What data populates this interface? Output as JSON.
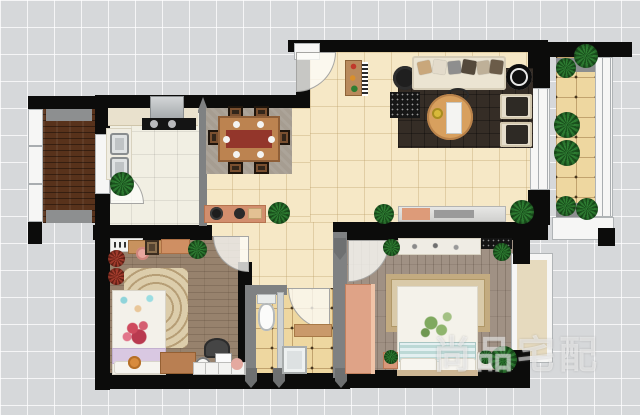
{
  "image": {
    "type": "apartment-floor-plan-rendering",
    "width_px": 640,
    "height_px": 415
  },
  "watermark": {
    "text": "尚品宅配"
  },
  "palette": {
    "background_grid": "#d6d8da",
    "wall_black": "#0c0c0b",
    "wall_grey": "#7f8182",
    "tile_living": "#f6e8c6",
    "tile_bathroom_balcony": "#eed7a0",
    "tile_kitchen": "#f1efe3",
    "wood_balcony_dark": "#58321b",
    "wood_bedroom": "#97826d",
    "wood_master": "#a09184",
    "rug_living_dark": "#352d26",
    "rug_dining_stone": "#a69d91",
    "rug_mandala": "#dccdab",
    "sofa_cream": "#ebe4d2",
    "table_wood": "#d8a05e",
    "accent_salmon": "#d28e6d",
    "plant_green": "#2e7d32"
  },
  "rooms": [
    {
      "name": "entry"
    },
    {
      "name": "living-room",
      "furniture": [
        "sofa",
        "coffee-table",
        "armchairs",
        "tv-cabinet",
        "side-table",
        "rug",
        "console"
      ]
    },
    {
      "name": "dining-area",
      "furniture": [
        "dining-table",
        "six-chairs",
        "stone-rug",
        "sideboard"
      ]
    },
    {
      "name": "kitchen",
      "furniture": [
        "counter",
        "range-hood",
        "stove",
        "double-sink",
        "plant"
      ]
    },
    {
      "name": "balcony-left",
      "furniture": [
        "wood-deck",
        "mats"
      ]
    },
    {
      "name": "balcony-right",
      "furniture": [
        "plants",
        "mats"
      ]
    },
    {
      "name": "bedroom-second",
      "furniture": [
        "bed",
        "mandala-rug",
        "desk",
        "chair",
        "shelf",
        "dresser",
        "clock"
      ]
    },
    {
      "name": "bathroom",
      "furniture": [
        "toilet",
        "shower-tray",
        "glass-partition",
        "shelf"
      ]
    },
    {
      "name": "master-bedroom",
      "furniture": [
        "double-bed",
        "rug",
        "wardrobe",
        "dresser",
        "tv",
        "nightstands",
        "bay-window",
        "plants"
      ]
    }
  ]
}
